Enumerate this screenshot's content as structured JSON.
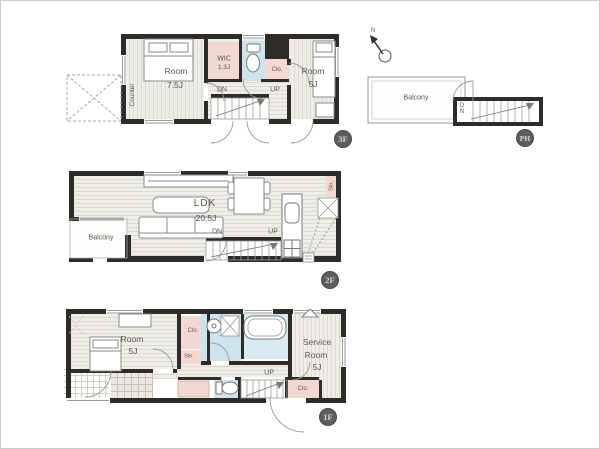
{
  "colors": {
    "wall": "#2e2b28",
    "closet_pink": "#f2d8d1",
    "wet_blue": "#cde4ef",
    "counter_khaki": "#d6d0a8",
    "badge_gray": "#5d5d5d"
  },
  "plan": {
    "f3": {
      "badge": "3F",
      "room1_name": "Room",
      "room1_size": "7.5J",
      "wic_name": "WIC",
      "wic_size": "1.3J",
      "clo": "Clo.",
      "room2_name": "Room",
      "room2_size": "5J",
      "counter": "Counter",
      "dn": "DN",
      "up": "UP"
    },
    "ph": {
      "badge": "PH",
      "north": "N",
      "balcony": "Balcony",
      "dn": "DN"
    },
    "f2": {
      "badge": "2F",
      "ldk_name": "LDK",
      "ldk_size": "20.5J",
      "balcony": "Balcony",
      "sto": "Sto.",
      "dn": "DN",
      "up": "UP"
    },
    "f1": {
      "badge": "1F",
      "room_name": "Room",
      "room_size": "5J",
      "clo1": "Clo.",
      "sto": "Sto.",
      "service1": "Service",
      "service2": "Room",
      "service3": "5J",
      "up": "UP",
      "clo2": "Clo."
    }
  }
}
